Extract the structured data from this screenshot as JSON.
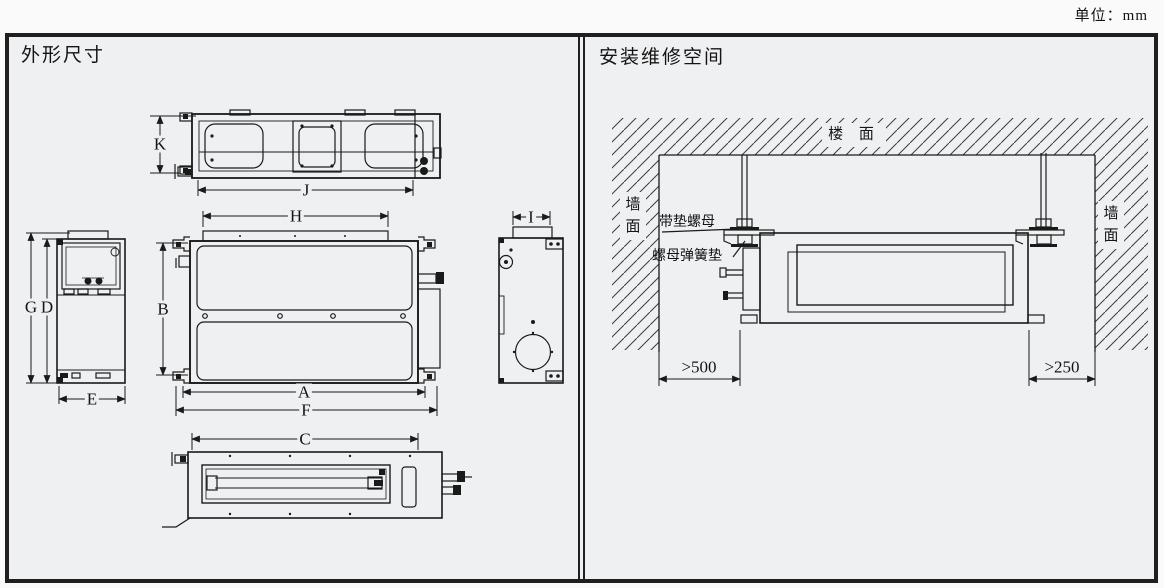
{
  "unit_note": "单位：mm",
  "panels": {
    "left": {
      "title": "外形尺寸"
    },
    "right": {
      "title": "安装维修空间"
    }
  },
  "dims": {
    "K": "K",
    "J": "J",
    "H": "H",
    "B": "B",
    "A": "A",
    "F": "F",
    "G": "G",
    "D": "D",
    "E": "E",
    "I": "I",
    "C": "C"
  },
  "install": {
    "ceiling": "楼 面",
    "wall_left": "墙面",
    "wall_right": "墙面",
    "nut_washer": "带垫螺母",
    "nut_spring_washer": "螺母弹簧垫",
    "min_clearance_left": ">500",
    "min_clearance_right": ">250"
  },
  "colors": {
    "line": "#1a1a1a",
    "panel_bg": "#eff0f2",
    "border": "#1f1f21"
  }
}
